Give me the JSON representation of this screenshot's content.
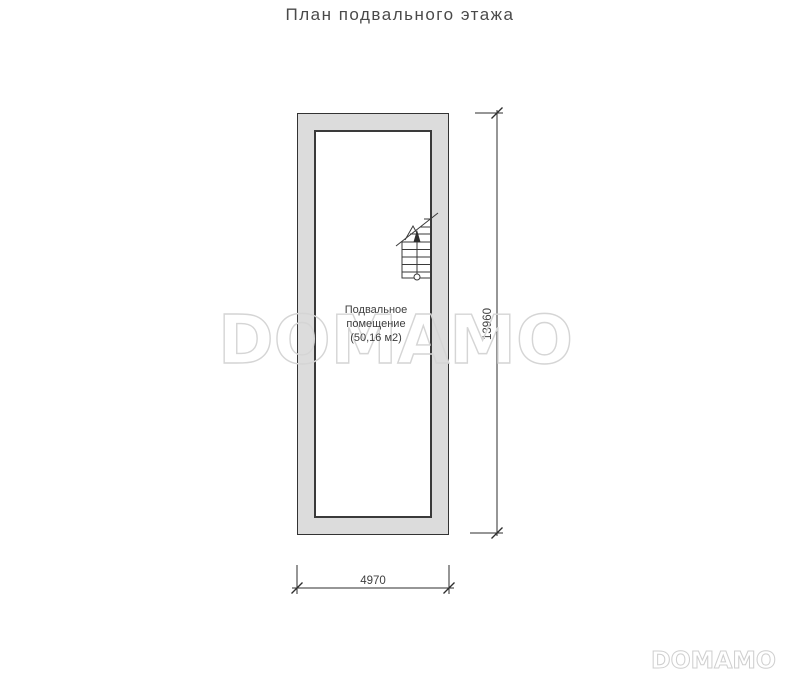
{
  "title": "План подвального этажа",
  "plan": {
    "room": {
      "lines": [
        "Подвальное",
        "помещение",
        "(50,16 м2)"
      ]
    },
    "dimensions": {
      "width_mm": "4970",
      "height_mm": "13960"
    }
  },
  "watermark": {
    "center_text": "DOMAMO",
    "corner_text": "DOMAMO"
  },
  "colors": {
    "wall_fill": "#dcdcdc",
    "wall_outline": "#333333",
    "drawing_line": "#2e2e2e",
    "text": "#3f3f3f",
    "watermark": "#d5d5d5"
  }
}
